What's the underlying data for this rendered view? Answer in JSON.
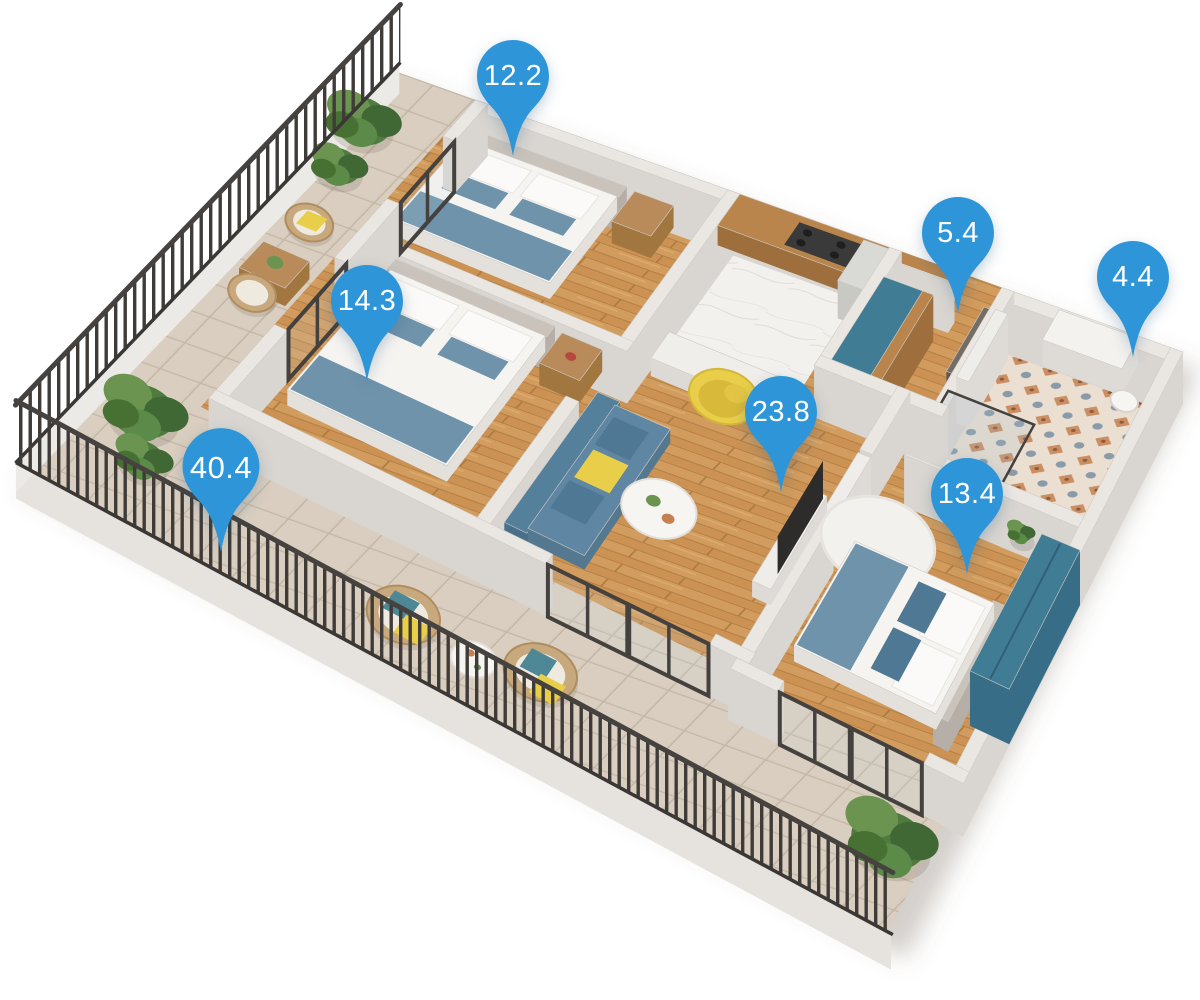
{
  "scene": {
    "description": "3D isometric apartment floor plan with room area markers"
  },
  "rooms": [
    {
      "id": "bedroom-1",
      "area": "12.2"
    },
    {
      "id": "bedroom-2",
      "area": "14.3"
    },
    {
      "id": "hallway",
      "area": "5.4"
    },
    {
      "id": "bathroom",
      "area": "4.4"
    },
    {
      "id": "living-room-kitchen",
      "area": "23.8"
    },
    {
      "id": "terrace",
      "area": "40.4"
    },
    {
      "id": "bedroom-3",
      "area": "13.4"
    }
  ],
  "colors": {
    "pin": "#2E96D8",
    "pin_text": "#FFFFFF",
    "wood_floor": "#CB9254",
    "terrace_tile": "#D7CCBD",
    "marble": "#F3F1EE",
    "bath_tile_base": "#EADFD0",
    "bath_tile_orange": "#C5804F",
    "bath_tile_blue": "#72889F",
    "wall_top": "#EAE7E3",
    "wall_face": "#D9D5D0",
    "frame_dark": "#44413E",
    "railing": "#3E3B38",
    "sofa_blue": "#5F87A3",
    "pillow_teal": "#4E7893",
    "accent_yellow": "#E9CE49",
    "bed_white": "#F6F4F1",
    "blanket_blue": "#6E93AB",
    "wardrobe_teal": "#417C95",
    "wicker": "#C8A97E",
    "plant_green": "#4F7B3F",
    "door_gray": "#746D66"
  }
}
